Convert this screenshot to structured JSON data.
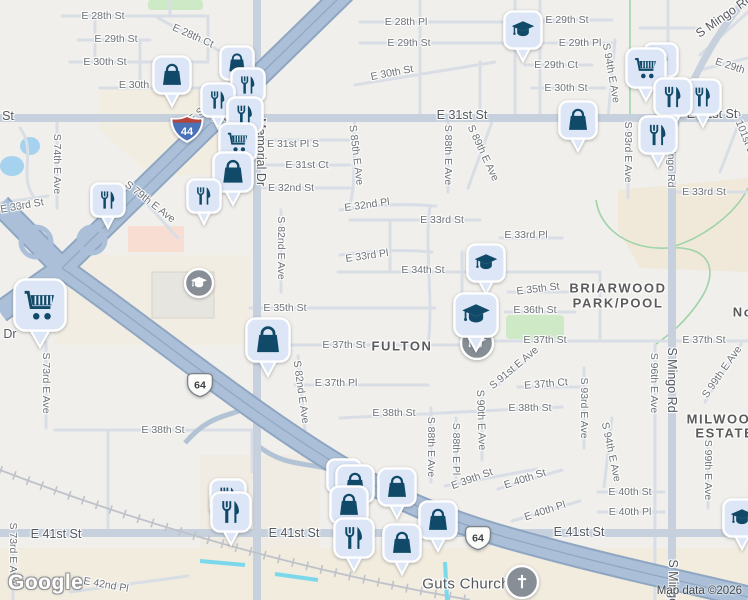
{
  "map": {
    "watermark": "Google",
    "attribution": "Map data ©2026",
    "neighborhoods": [
      {
        "t": "FULTON",
        "x": 402,
        "y": 346
      },
      {
        "t": "BRIARWOOD",
        "x": 618,
        "y": 288
      },
      {
        "t": "PARK/POOL",
        "x": 618,
        "y": 303
      },
      {
        "t": "MILWOOD",
        "x": 724,
        "y": 419
      },
      {
        "t": "ESTATES",
        "x": 730,
        "y": 433
      },
      {
        "t": "No",
        "x": 743,
        "y": 312
      }
    ],
    "poi_labels": [
      {
        "t": "Guts Church",
        "x": 466,
        "y": 584
      }
    ],
    "street_labels": [
      {
        "t": "E 28th St",
        "x": 103,
        "y": 16,
        "r": 0,
        "c": "sl"
      },
      {
        "t": "E 28th Ct",
        "x": 193,
        "y": 36,
        "r": 24,
        "c": "sl"
      },
      {
        "t": "E 29th St",
        "x": 116,
        "y": 39,
        "r": 0,
        "c": "sl"
      },
      {
        "t": "E 30th St",
        "x": 105,
        "y": 62,
        "r": 0,
        "c": "sl"
      },
      {
        "t": "E 30th",
        "x": 134,
        "y": 85,
        "r": 0,
        "c": "sl"
      },
      {
        "t": "St",
        "x": 8,
        "y": 116,
        "r": 0,
        "c": "al"
      },
      {
        "t": "S 74th E Ave",
        "x": 57,
        "y": 164,
        "r": 90,
        "c": "sl"
      },
      {
        "t": "E 33rd St",
        "x": 22,
        "y": 206,
        "r": -10,
        "c": "sl"
      },
      {
        "t": "S 79th E Ave",
        "x": 150,
        "y": 202,
        "r": 38,
        "c": "sl"
      },
      {
        "t": "E Skelly Dr",
        "x": 210,
        "y": 104,
        "r": -40,
        "c": "sl"
      },
      {
        "t": "Memorial Dr",
        "x": 261,
        "y": 152,
        "r": 90,
        "c": "al"
      },
      {
        "t": "E 31st St",
        "x": 237,
        "y": 117,
        "r": 0,
        "c": "al"
      },
      {
        "t": "E 28th Pl",
        "x": 406,
        "y": 22,
        "r": 0,
        "c": "sl"
      },
      {
        "t": "E 29th St",
        "x": 409,
        "y": 43,
        "r": 0,
        "c": "sl"
      },
      {
        "t": "E 30th St",
        "x": 392,
        "y": 73,
        "r": -11,
        "c": "sl"
      },
      {
        "t": "E 31st St",
        "x": 462,
        "y": 115,
        "r": 0,
        "c": "al"
      },
      {
        "t": "E 31st Pl S",
        "x": 293,
        "y": 144,
        "r": 0,
        "c": "sl"
      },
      {
        "t": "E 31st Ct",
        "x": 307,
        "y": 165,
        "r": 0,
        "c": "sl"
      },
      {
        "t": "E 32nd St",
        "x": 291,
        "y": 188,
        "r": 0,
        "c": "sl"
      },
      {
        "t": "S 85th E Ave",
        "x": 356,
        "y": 155,
        "r": 83,
        "c": "sl"
      },
      {
        "t": "S 88th E Ave",
        "x": 448,
        "y": 155,
        "r": 90,
        "c": "sl"
      },
      {
        "t": "S 89th E Ave",
        "x": 483,
        "y": 153,
        "r": 65,
        "c": "sl"
      },
      {
        "t": "E 29th St",
        "x": 567,
        "y": 20,
        "r": 0,
        "c": "sl"
      },
      {
        "t": "E 29th Pl",
        "x": 580,
        "y": 43,
        "r": 0,
        "c": "sl"
      },
      {
        "t": "E 29th Ct",
        "x": 556,
        "y": 65,
        "r": 0,
        "c": "sl"
      },
      {
        "t": "E 30th St",
        "x": 566,
        "y": 88,
        "r": 0,
        "c": "sl"
      },
      {
        "t": "S 94th E Ave",
        "x": 611,
        "y": 73,
        "r": 80,
        "c": "sl"
      },
      {
        "t": "S Mingo Rd",
        "x": 724,
        "y": 16,
        "r": -35,
        "c": "al"
      },
      {
        "t": "E 29th",
        "x": 730,
        "y": 66,
        "r": 18,
        "c": "sl"
      },
      {
        "t": "S 93rd E Ave",
        "x": 628,
        "y": 152,
        "r": 90,
        "c": "sl"
      },
      {
        "t": "S Mingo Rd",
        "x": 671,
        "y": 160,
        "r": 90,
        "c": "sl"
      },
      {
        "t": "E 33rd St",
        "x": 704,
        "y": 192,
        "r": 0,
        "c": "sl"
      },
      {
        "t": "S 101st E Ave",
        "x": 747,
        "y": 142,
        "r": 68,
        "c": "sl"
      },
      {
        "t": "E 32nd Pl",
        "x": 367,
        "y": 205,
        "r": -8,
        "c": "sl"
      },
      {
        "t": "E 33rd St",
        "x": 442,
        "y": 220,
        "r": 0,
        "c": "sl"
      },
      {
        "t": "E 33rd Pl",
        "x": 367,
        "y": 256,
        "r": -8,
        "c": "sl"
      },
      {
        "t": "E 34th St",
        "x": 423,
        "y": 270,
        "r": 0,
        "c": "sl"
      },
      {
        "t": "E 35th St",
        "x": 285,
        "y": 308,
        "r": 0,
        "c": "sl"
      },
      {
        "t": "E 37th St",
        "x": 344,
        "y": 345,
        "r": 0,
        "c": "sl"
      },
      {
        "t": "E 37th Pl",
        "x": 336,
        "y": 383,
        "r": 0,
        "c": "sl"
      },
      {
        "t": "S 82nd E Ave",
        "x": 281,
        "y": 248,
        "r": 90,
        "c": "sl"
      },
      {
        "t": "S 82nd E Ave",
        "x": 301,
        "y": 392,
        "r": 82,
        "c": "sl"
      },
      {
        "t": "E 33rd Pl",
        "x": 526,
        "y": 235,
        "r": 0,
        "c": "sl"
      },
      {
        "t": "E 35th St",
        "x": 538,
        "y": 289,
        "r": -7,
        "c": "sl"
      },
      {
        "t": "E 36th St",
        "x": 535,
        "y": 310,
        "r": 0,
        "c": "sl"
      },
      {
        "t": "E 37th St",
        "x": 545,
        "y": 340,
        "r": 0,
        "c": "sl"
      },
      {
        "t": "E 37th St",
        "x": 704,
        "y": 340,
        "r": 0,
        "c": "sl"
      },
      {
        "t": "E 37th Ct",
        "x": 546,
        "y": 384,
        "r": -5,
        "c": "sl"
      },
      {
        "t": "S 91st E Ave",
        "x": 514,
        "y": 368,
        "r": -40,
        "c": "sl"
      },
      {
        "t": "S 93rd E Ave",
        "x": 584,
        "y": 408,
        "r": 90,
        "c": "sl"
      },
      {
        "t": "S 96th E Ave",
        "x": 654,
        "y": 383,
        "r": 90,
        "c": "sl"
      },
      {
        "t": "S Mingo Rd",
        "x": 672,
        "y": 380,
        "r": 90,
        "c": "al"
      },
      {
        "t": "S Mingo Rd",
        "x": 673,
        "y": 592,
        "r": 90,
        "c": "al"
      },
      {
        "t": "S 99th E Ave",
        "x": 722,
        "y": 372,
        "r": -55,
        "c": "sl"
      },
      {
        "t": "S 99th E Ave",
        "x": 708,
        "y": 470,
        "r": 90,
        "c": "sl"
      },
      {
        "t": "E 38th St",
        "x": 163,
        "y": 430,
        "r": 0,
        "c": "sl"
      },
      {
        "t": "E 38th St",
        "x": 394,
        "y": 413,
        "r": 0,
        "c": "sl"
      },
      {
        "t": "E 38th St",
        "x": 530,
        "y": 408,
        "r": 0,
        "c": "sl"
      },
      {
        "t": "S 88th E Ave",
        "x": 431,
        "y": 447,
        "r": 90,
        "c": "sl"
      },
      {
        "t": "S 88th E Pl",
        "x": 456,
        "y": 449,
        "r": 90,
        "c": "sl"
      },
      {
        "t": "E 39th St",
        "x": 472,
        "y": 479,
        "r": -20,
        "c": "sl"
      },
      {
        "t": "S 90th E Ave",
        "x": 481,
        "y": 420,
        "r": 88,
        "c": "sl"
      },
      {
        "t": "E 40th St",
        "x": 525,
        "y": 479,
        "r": -18,
        "c": "sl"
      },
      {
        "t": "E 40th St",
        "x": 630,
        "y": 492,
        "r": 0,
        "c": "sl"
      },
      {
        "t": "E 40th Pl",
        "x": 545,
        "y": 511,
        "r": -18,
        "c": "sl"
      },
      {
        "t": "E 40th Pl",
        "x": 630,
        "y": 512,
        "r": 0,
        "c": "sl"
      },
      {
        "t": "E 41st St",
        "x": 56,
        "y": 534,
        "r": 0,
        "c": "al"
      },
      {
        "t": "E 41st St",
        "x": 294,
        "y": 533,
        "r": 0,
        "c": "al"
      },
      {
        "t": "E 41st St",
        "x": 579,
        "y": 532,
        "r": 0,
        "c": "al"
      },
      {
        "t": "E 31st St",
        "x": 712,
        "y": 114,
        "r": 0,
        "c": "al"
      },
      {
        "t": "S 94th E Ave",
        "x": 611,
        "y": 452,
        "r": 78,
        "c": "sl"
      },
      {
        "t": "E 42nd Pl",
        "x": 106,
        "y": 585,
        "r": 10,
        "c": "sl"
      },
      {
        "t": "S 73rd E Ave",
        "x": 46,
        "y": 383,
        "r": 90,
        "c": "sl"
      },
      {
        "t": "S 73rd E Ave",
        "x": 13,
        "y": 553,
        "r": 90,
        "c": "sl"
      },
      {
        "t": "Dr",
        "x": 10,
        "y": 334,
        "r": 0,
        "c": "al"
      }
    ],
    "shields": [
      {
        "type": "interstate",
        "label": "44",
        "x": 187,
        "y": 129
      },
      {
        "type": "us",
        "label": "64",
        "x": 200,
        "y": 385
      },
      {
        "type": "us",
        "label": "64",
        "x": 478,
        "y": 538
      }
    ],
    "poi_circles": [
      {
        "i": "school",
        "x": 199,
        "y": 283,
        "r": 14
      },
      {
        "i": "school",
        "x": 477,
        "y": 343,
        "r": 16
      },
      {
        "i": "church",
        "x": 522,
        "y": 582,
        "r": 16
      }
    ],
    "pins": [
      {
        "i": "school",
        "x": 523,
        "y": 30,
        "s": 40
      },
      {
        "i": "bag",
        "x": 172,
        "y": 75,
        "s": 40
      },
      {
        "i": "bag",
        "x": 237,
        "y": 63,
        "s": 36
      },
      {
        "i": "restaurant",
        "x": 248,
        "y": 85,
        "s": 36
      },
      {
        "i": "restaurant",
        "x": 218,
        "y": 100,
        "s": 36
      },
      {
        "i": "restaurant",
        "x": 245,
        "y": 115,
        "s": 38
      },
      {
        "i": "cart",
        "x": 238,
        "y": 142,
        "s": 40
      },
      {
        "i": "bag",
        "x": 233,
        "y": 172,
        "s": 42
      },
      {
        "i": "restaurant",
        "x": 108,
        "y": 200,
        "s": 36
      },
      {
        "i": "restaurant",
        "x": 204,
        "y": 196,
        "s": 36
      },
      {
        "i": "cart",
        "x": 40,
        "y": 305,
        "s": 54
      },
      {
        "i": "bag",
        "x": 268,
        "y": 340,
        "s": 46
      },
      {
        "i": "school",
        "x": 486,
        "y": 263,
        "s": 40
      },
      {
        "i": "school",
        "x": 476,
        "y": 315,
        "s": 46
      },
      {
        "i": "bag",
        "x": 578,
        "y": 120,
        "s": 40
      },
      {
        "i": "restaurant",
        "x": 661,
        "y": 60,
        "s": 36
      },
      {
        "i": "restaurant",
        "x": 703,
        "y": 97,
        "s": 38
      },
      {
        "i": "cart",
        "x": 646,
        "y": 68,
        "s": 42
      },
      {
        "i": "restaurant",
        "x": 673,
        "y": 97,
        "s": 40
      },
      {
        "i": "restaurant",
        "x": 658,
        "y": 135,
        "s": 40
      },
      {
        "i": "bag",
        "x": 344,
        "y": 476,
        "s": 36
      },
      {
        "i": "bag",
        "x": 355,
        "y": 484,
        "s": 40
      },
      {
        "i": "bag",
        "x": 397,
        "y": 487,
        "s": 40
      },
      {
        "i": "bag",
        "x": 349,
        "y": 505,
        "s": 40
      },
      {
        "i": "bag",
        "x": 438,
        "y": 520,
        "s": 40
      },
      {
        "i": "restaurant",
        "x": 228,
        "y": 497,
        "s": 38
      },
      {
        "i": "restaurant",
        "x": 231,
        "y": 512,
        "s": 42
      },
      {
        "i": "restaurant",
        "x": 354,
        "y": 538,
        "s": 42
      },
      {
        "i": "bag",
        "x": 402,
        "y": 543,
        "s": 40
      },
      {
        "i": "school",
        "x": 742,
        "y": 518,
        "s": 40
      }
    ]
  },
  "colors": {
    "pin_fill": "#dce6f7",
    "pin_glyph": "#114a68",
    "circle_gray": "#878e96",
    "interstate_blue": "#4a72b8",
    "interstate_red": "#b5443c",
    "us_shield": "#fbfbf9",
    "water": "#a5d2ee",
    "canal": "#7bd8ea",
    "park_green": "#cde9c6",
    "highway": "#abc0d8"
  }
}
